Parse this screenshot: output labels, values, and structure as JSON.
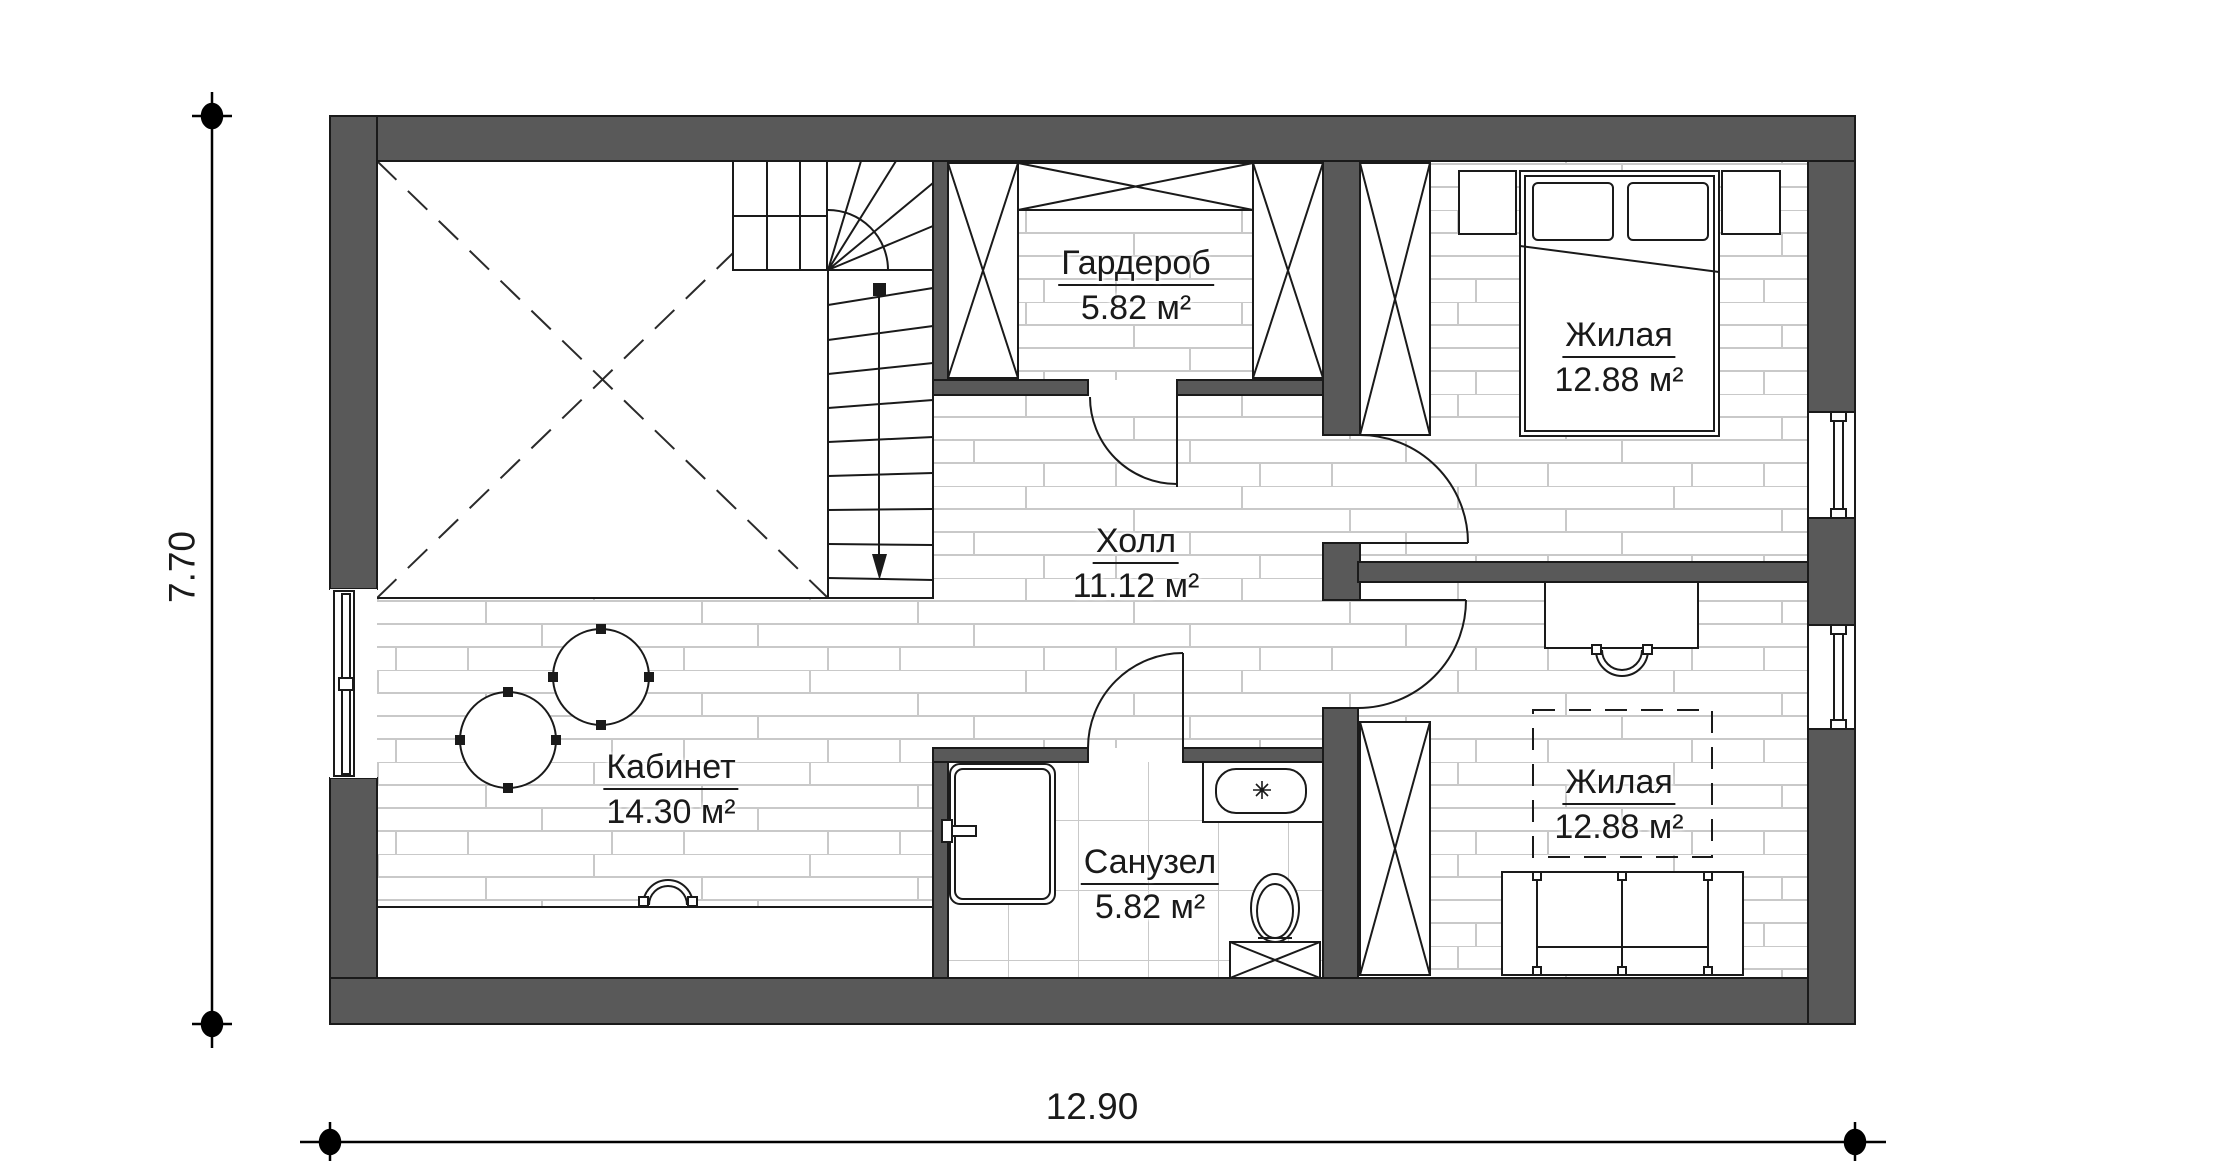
{
  "rooms": [
    {
      "id": "wardrobe",
      "name": "Гардероб",
      "area": "5.82 м²"
    },
    {
      "id": "bedroom-top",
      "name": "Жилая",
      "area": "12.88 м²"
    },
    {
      "id": "hall",
      "name": "Холл",
      "area": "11.12 м²"
    },
    {
      "id": "office",
      "name": "Кабинет",
      "area": "14.30 м²"
    },
    {
      "id": "bathroom",
      "name": "Санузел",
      "area": "5.82 м²"
    },
    {
      "id": "bedroom-bottom",
      "name": "Жилая",
      "area": "12.88 м²"
    }
  ],
  "dimensions": {
    "width_m": "12.90",
    "height_m": "7.70"
  },
  "colors": {
    "wall": "#595959",
    "outline": "#1a1a1a",
    "floor_line": "#c9c9c9",
    "background": "#ffffff",
    "text": "#1a1a1a"
  },
  "symbols": {
    "stairs": "winder-staircase-with-direction-arrow",
    "void": "open-to-below-dashed-cross",
    "wardrobe_unit": "crossed-box-cabinet",
    "bed": "double-bed-with-pillows",
    "sofa": "three-seat-sofa",
    "desk": "desk-with-chair",
    "round_table": "round-table",
    "shower": "shower-tray",
    "sink": "vanity-sink",
    "toilet": "toilet-with-cistern",
    "window": "double-glazed-window",
    "door": "swing-door-arc"
  }
}
